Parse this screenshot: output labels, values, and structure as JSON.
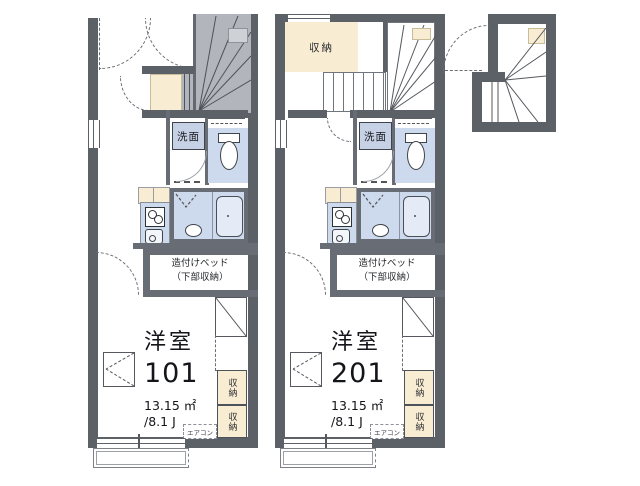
{
  "colors": {
    "wall_dark": "#5c6067",
    "wall_mid": "#686d75",
    "stair_gray": "#b2b6bc",
    "storage_cream": "#f8ecd3",
    "wet_room_blue": "#cdd9ec",
    "washbasin_label_bg": "#c7d1e5",
    "text": "#141519",
    "background": "#ffffff"
  },
  "units": [
    {
      "room_type": "洋室",
      "room_number": "101",
      "area": "13.15 ㎡",
      "tatami": "/8.1 J",
      "bed_line1": "造付けベッド",
      "bed_line2": "（下部収納）",
      "washbasin": "洗面",
      "storage1": "収納",
      "storage2": "収納",
      "aircon": "エアコン"
    },
    {
      "room_type": "洋室",
      "room_number": "201",
      "area": "13.15 ㎡",
      "tatami": "/8.1 J",
      "closet": "収納",
      "bed_line1": "造付けベッド",
      "bed_line2": "（下部収納）",
      "washbasin": "洗面",
      "storage1": "収納",
      "storage2": "収納",
      "aircon": "エアコン"
    }
  ]
}
